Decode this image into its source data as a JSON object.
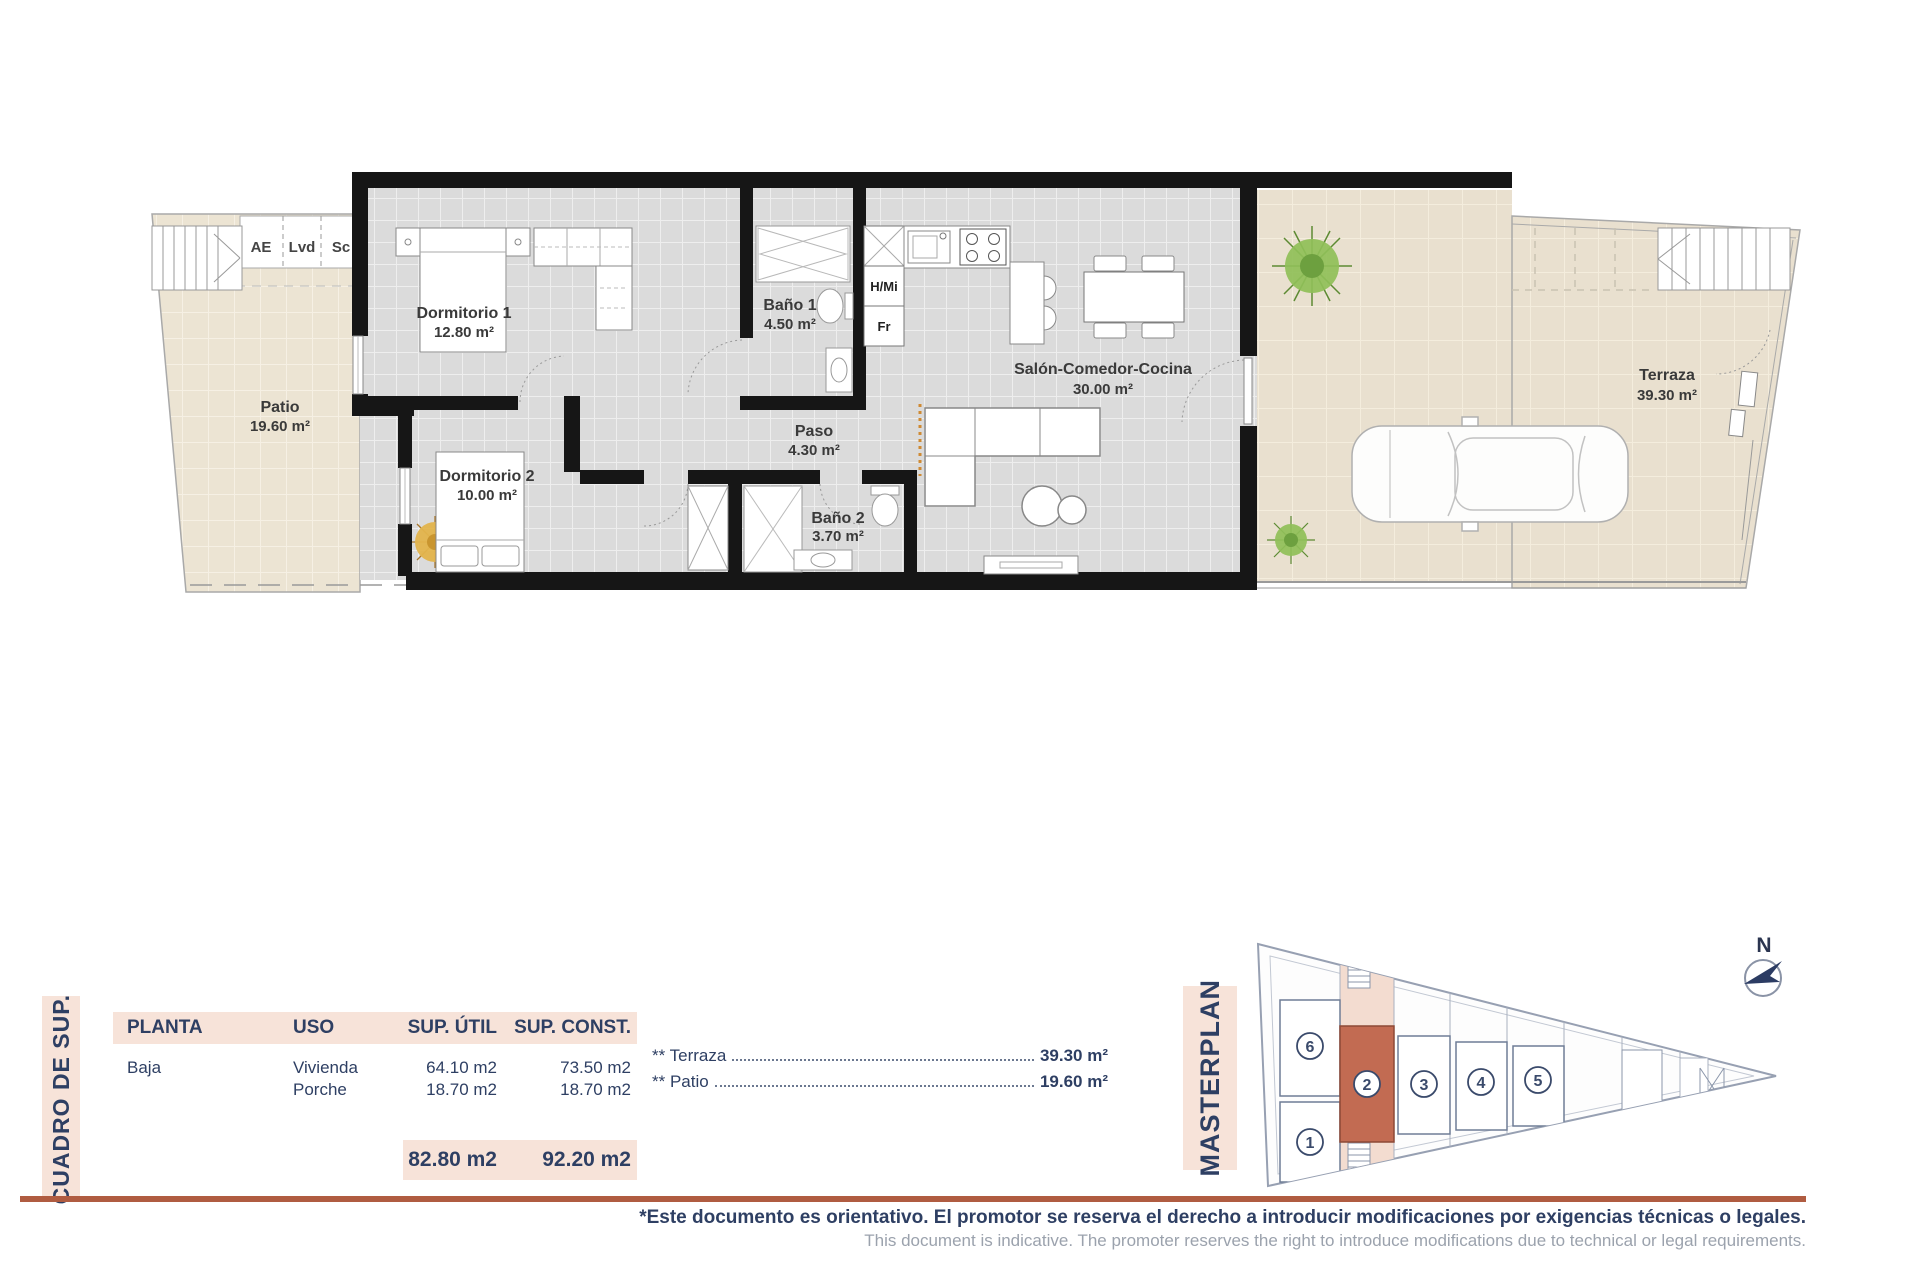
{
  "floorplan": {
    "utility_labels": [
      "AE",
      "Lvd",
      "Sc"
    ],
    "appliances": {
      "hmi": "H/Mi",
      "fr": "Fr"
    },
    "rooms": [
      {
        "name": "Patio",
        "area": "19.60 m²"
      },
      {
        "name": "Dormitorio 1",
        "area": "12.80 m²"
      },
      {
        "name": "Dormitorio 2",
        "area": "10.00 m²"
      },
      {
        "name": "Baño 1",
        "area": "4.50 m²"
      },
      {
        "name": "Baño 2",
        "area": "3.70 m²"
      },
      {
        "name": "Paso",
        "area": "4.30 m²"
      },
      {
        "name": "Salón-Comedor-Cocina",
        "area": "30.00 m²"
      },
      {
        "name": "Terraza",
        "area": "39.30 m²"
      }
    ]
  },
  "summary_table": {
    "side_label": "CUADRO DE SUP.",
    "columns": [
      "PLANTA",
      "USO",
      "SUP. ÚTIL",
      "SUP. CONST."
    ],
    "rows": [
      {
        "planta": "Baja",
        "uso": "Vivienda",
        "util": "64.10 m2",
        "const": "73.50 m2"
      },
      {
        "planta": "",
        "uso": "Porche",
        "util": "18.70 m2",
        "const": "18.70 m2"
      }
    ],
    "totals": {
      "util": "82.80 m2",
      "const": "92.20 m2"
    },
    "extras": [
      {
        "label": "** Terraza",
        "value": "39.30 m²"
      },
      {
        "label": "** Patio",
        "value": "19.60 m²"
      }
    ]
  },
  "masterplan": {
    "side_label": "MASTERPLAN",
    "north_label": "N",
    "units": [
      "1",
      "2",
      "3",
      "4",
      "5",
      "6"
    ],
    "highlighted_unit": "2"
  },
  "footer": {
    "disclaimer_es": "*Este documento es orientativo. El promotor se reserva el derecho a introducir modificaciones por exigencias técnicas o legales.",
    "disclaimer_en": "This document is indicative. The promoter reserves the right to introduce modifications due to technical or legal requirements."
  },
  "colors": {
    "accent_terracotta": "#b05c41",
    "highlighted_unit_fill": "#c26b52",
    "panel_pink": "#f7e3d9",
    "navy_text": "#2e3f63"
  }
}
